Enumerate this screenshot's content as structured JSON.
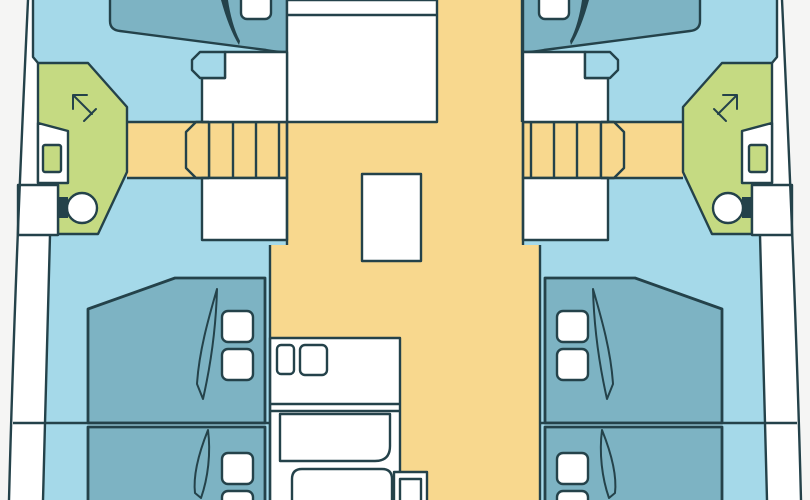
{
  "title": "Catamaran yacht interior floor plan, top-down view",
  "colors": {
    "background": "#f5f5f4",
    "hull_white": "#ffffff",
    "cabin_floor_blue": "#a5d9e9",
    "berth_teal": "#7db3c3",
    "deck_yellow": "#f8d88e",
    "bathroom_green": "#c5da82",
    "outline": "#24424a",
    "fixture_black": "#1c1c1c"
  },
  "layout": {
    "orientation": "bow-cut-top, stern-cut-bottom",
    "hulls": 2,
    "salon": {
      "table": 1,
      "corridor": 1
    },
    "galley": {
      "sinks": 2,
      "counters": 3,
      "appliance_box": 1
    },
    "stairways": {
      "count": 2,
      "treads_each": 4,
      "landing_each": 1
    },
    "heads": {
      "count": 2,
      "fixtures_each": [
        "shower-arrow",
        "sink",
        "toilet"
      ]
    },
    "berths": {
      "forward_partial": 2,
      "aft": 4,
      "pillows_visible": 10,
      "blanket_folds": 6
    },
    "dressers": 4,
    "step_boxes": 2
  }
}
